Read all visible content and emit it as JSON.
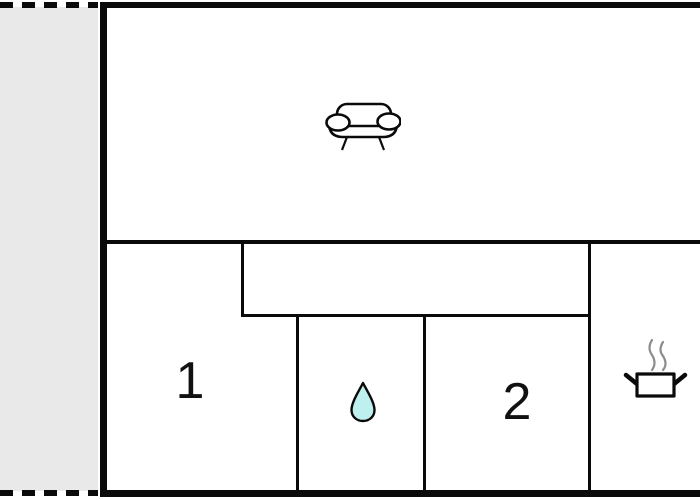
{
  "floorplan": {
    "rooms": {
      "living": {
        "name": "living room",
        "label": "",
        "icon": "sofa-icon"
      },
      "bedroom1": {
        "name": "bedroom 1",
        "label": "1"
      },
      "bathroom": {
        "name": "bathroom",
        "label": "",
        "icon": "water-drop-icon"
      },
      "bedroom2": {
        "name": "bedroom 2",
        "label": "2"
      },
      "kitchen": {
        "name": "kitchen",
        "label": "",
        "icon": "cooking-pot-icon"
      },
      "hallway": {
        "name": "hallway",
        "label": ""
      },
      "terrace": {
        "name": "terrace",
        "label": ""
      }
    },
    "colors": {
      "wall": "#0a0a0a",
      "terrace_fill": "#e9e9e9",
      "water_drop_fill": "#bdf0ee",
      "steam": "#8c8c8c",
      "background": "#ffffff"
    }
  }
}
